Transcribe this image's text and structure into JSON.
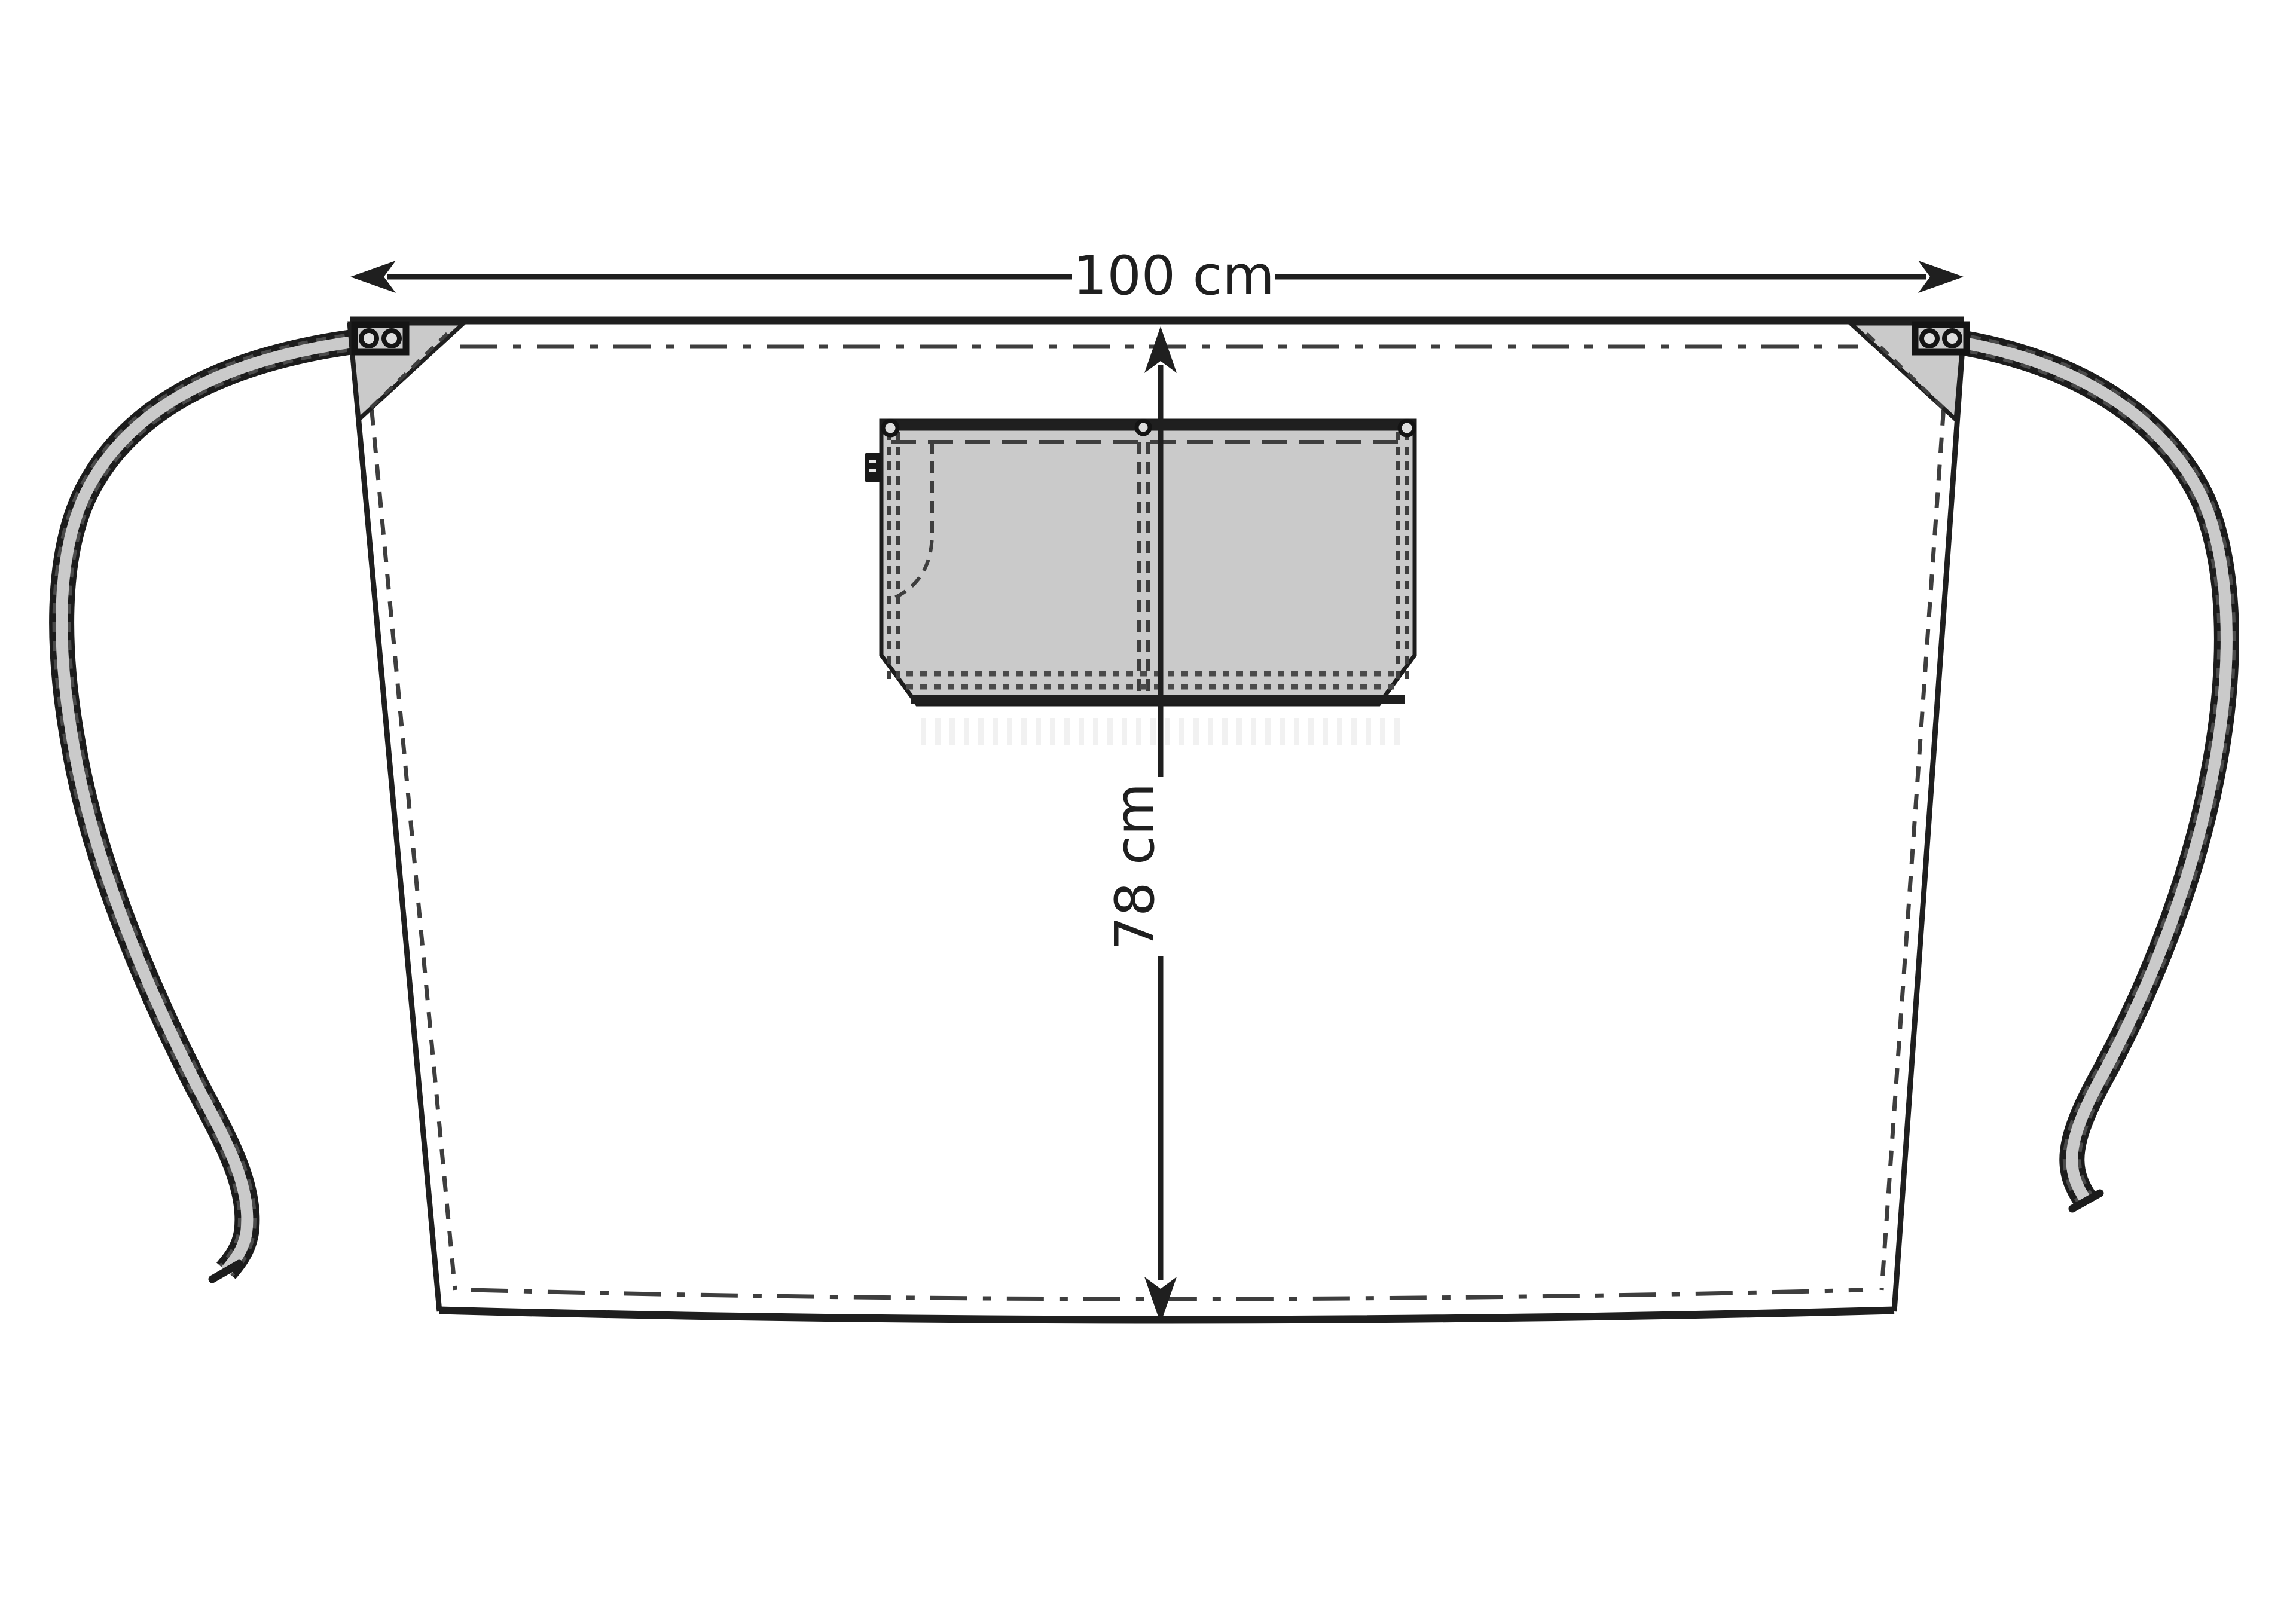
{
  "drawing": {
    "subject": "Waist apron with front pocket — flat technical sketch, front view",
    "width_label": "100 cm",
    "height_label": "78 cm"
  },
  "colors": {
    "background": "#ffffff",
    "outline": "#1f1f1f",
    "fabric": "#cacaca",
    "stitch": "#3e3e3e",
    "stitch_dots": "#4a4a4a",
    "watermark": "#f1f1f1",
    "tag": "#191919"
  },
  "parts": {
    "waist_ties": 2,
    "corner_rivets_per_side": 2,
    "pocket_rivets": 3,
    "pocket_compartments": 2
  }
}
